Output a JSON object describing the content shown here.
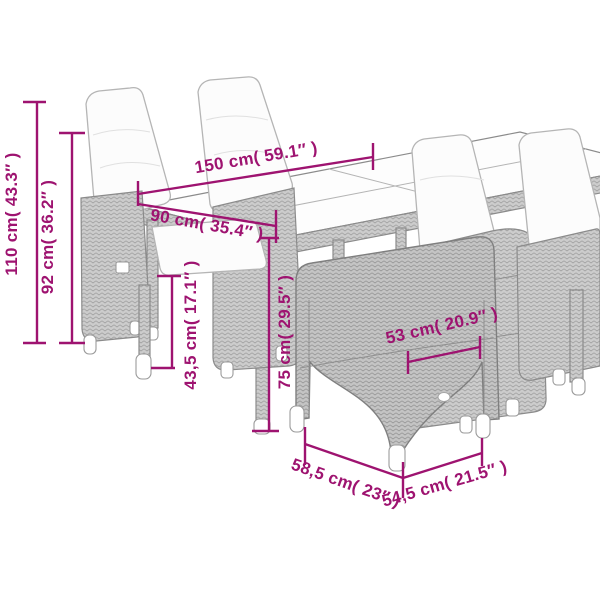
{
  "diagram": {
    "kind": "product-dimension-diagram",
    "subject": "garden-dining-set-with-table-and-reclining-chairs"
  },
  "colors": {
    "dimension_accent": "#9E1370",
    "background": "#ffffff",
    "rattan_gray": "#cccccc",
    "cushion_white": "#fcfcfc"
  },
  "dimensions": [
    {
      "id": "table-length",
      "label": "150 cm( 59.1″ )"
    },
    {
      "id": "table-depth",
      "label": "90 cm( 35.4″ )"
    },
    {
      "id": "total-height",
      "label": "110 cm( 43.3″ )"
    },
    {
      "id": "backrest-height",
      "label": "92 cm( 36.2″ )"
    },
    {
      "id": "table-height",
      "label": "75 cm( 29.5″ )"
    },
    {
      "id": "seat-height",
      "label": "43,5 cm( 17.1″ )"
    },
    {
      "id": "seat-width",
      "label": "53 cm( 20.9″ )"
    },
    {
      "id": "chair-width",
      "label": "58,5 cm( 23″ )"
    },
    {
      "id": "chair-depth",
      "label": "54,5 cm( 21.5″ )"
    }
  ]
}
